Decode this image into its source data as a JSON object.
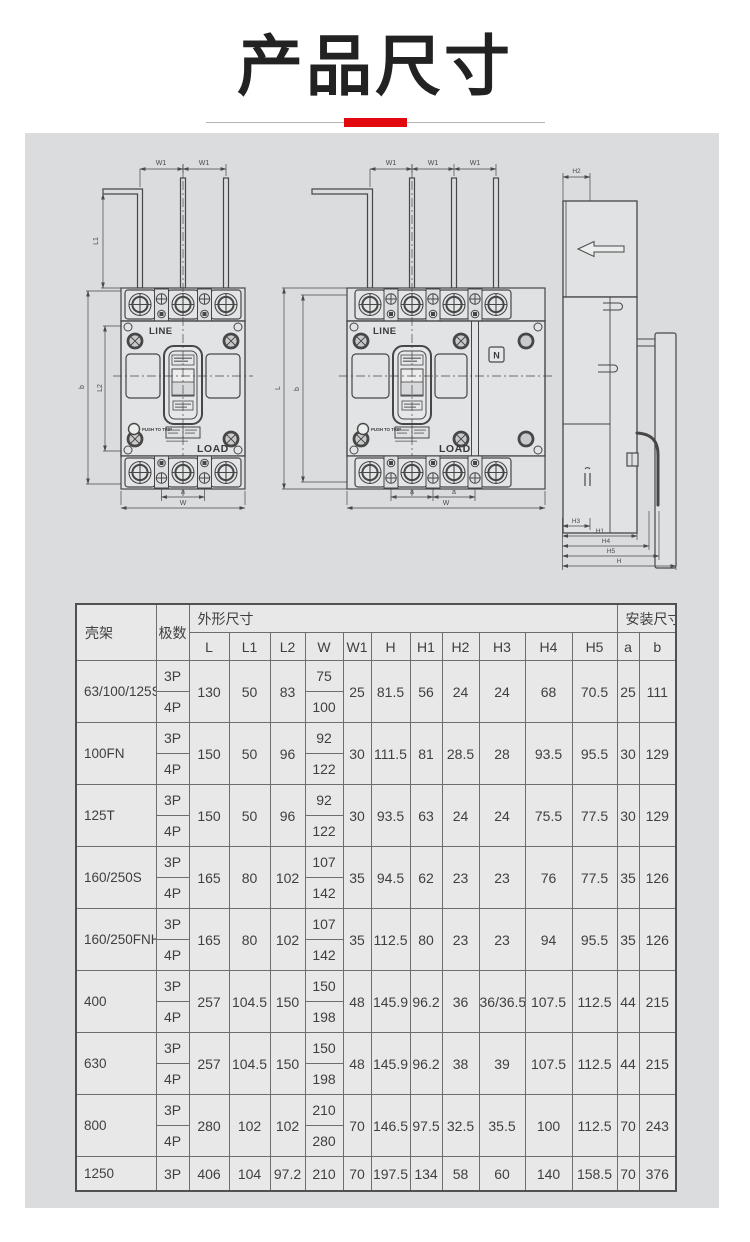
{
  "title": {
    "text": "产品尺寸"
  },
  "diagram": {
    "view_labels": {
      "line": "LINE",
      "load": "LOAD",
      "push_to_trip": "PUSH TO TRIP",
      "neutral": "N"
    },
    "dims": {
      "W1": "W1",
      "L1": "L1",
      "L": "L",
      "L2": "L2",
      "b": "b",
      "a": "a",
      "W": "W",
      "H": "H",
      "H1": "H1",
      "H2": "H2",
      "H3": "H3",
      "H4": "H4",
      "H5": "H5"
    }
  },
  "table": {
    "headers": {
      "frame": "壳架",
      "poles": "极数",
      "outline": "外形尺寸",
      "mounting": "安装尺寸",
      "dim_cols": [
        "L",
        "L1",
        "L2",
        "W",
        "W1",
        "H",
        "H1",
        "H2",
        "H3",
        "H4",
        "H5"
      ],
      "mount_cols": [
        "a",
        "b"
      ]
    },
    "rows": [
      {
        "frame": "63/100/125S",
        "poles": [
          "3P",
          "4P"
        ],
        "L": "130",
        "L1": "50",
        "L2": "83",
        "W": [
          "75",
          "100"
        ],
        "W1": "25",
        "H": "81.5",
        "H1": "56",
        "H2": "24",
        "H3": "24",
        "H4": "68",
        "H5": "70.5",
        "a": "25",
        "b": "111"
      },
      {
        "frame": "100FN",
        "poles": [
          "3P",
          "4P"
        ],
        "L": "150",
        "L1": "50",
        "L2": "96",
        "W": [
          "92",
          "122"
        ],
        "W1": "30",
        "H": "111.5",
        "H1": "81",
        "H2": "28.5",
        "H3": "28",
        "H4": "93.5",
        "H5": "95.5",
        "a": "30",
        "b": "129"
      },
      {
        "frame": "125T",
        "poles": [
          "3P",
          "4P"
        ],
        "L": "150",
        "L1": "50",
        "L2": "96",
        "W": [
          "92",
          "122"
        ],
        "W1": "30",
        "H": "93.5",
        "H1": "63",
        "H2": "24",
        "H3": "24",
        "H4": "75.5",
        "H5": "77.5",
        "a": "30",
        "b": "129"
      },
      {
        "frame": "160/250S",
        "poles": [
          "3P",
          "4P"
        ],
        "L": "165",
        "L1": "80",
        "L2": "102",
        "W": [
          "107",
          "142"
        ],
        "W1": "35",
        "H": "94.5",
        "H1": "62",
        "H2": "23",
        "H3": "23",
        "H4": "76",
        "H5": "77.5",
        "a": "35",
        "b": "126"
      },
      {
        "frame": "160/250FNH",
        "poles": [
          "3P",
          "4P"
        ],
        "L": "165",
        "L1": "80",
        "L2": "102",
        "W": [
          "107",
          "142"
        ],
        "W1": "35",
        "H": "112.5",
        "H1": "80",
        "H2": "23",
        "H3": "23",
        "H4": "94",
        "H5": "95.5",
        "a": "35",
        "b": "126"
      },
      {
        "frame": "400",
        "poles": [
          "3P",
          "4P"
        ],
        "L": "257",
        "L1": "104.5",
        "L2": "150",
        "W": [
          "150",
          "198"
        ],
        "W1": "48",
        "H": "145.9",
        "H1": "96.2",
        "H2": "36",
        "H3": "36/36.5",
        "H4": "107.5",
        "H5": "112.5",
        "a": "44",
        "b": "215"
      },
      {
        "frame": "630",
        "poles": [
          "3P",
          "4P"
        ],
        "L": "257",
        "L1": "104.5",
        "L2": "150",
        "W": [
          "150",
          "198"
        ],
        "W1": "48",
        "H": "145.9",
        "H1": "96.2",
        "H2": "38",
        "H3": "39",
        "H4": "107.5",
        "H5": "112.5",
        "a": "44",
        "b": "215"
      },
      {
        "frame": "800",
        "poles": [
          "3P",
          "4P"
        ],
        "L": "280",
        "L1": "102",
        "L2": "102",
        "W": [
          "210",
          "280"
        ],
        "W1": "70",
        "H": "146.5",
        "H1": "97.5",
        "H2": "32.5",
        "H3": "35.5",
        "H4": "100",
        "H5": "112.5",
        "a": "70",
        "b": "243"
      },
      {
        "frame": "1250",
        "poles": [
          "3P"
        ],
        "L": "406",
        "L1": "104",
        "L2": "97.2",
        "W": [
          "210"
        ],
        "W1": "70",
        "H": "197.5",
        "H1": "134",
        "H2": "58",
        "H3": "60",
        "H4": "140",
        "H5": "158.5",
        "a": "70",
        "b": "376"
      }
    ]
  }
}
